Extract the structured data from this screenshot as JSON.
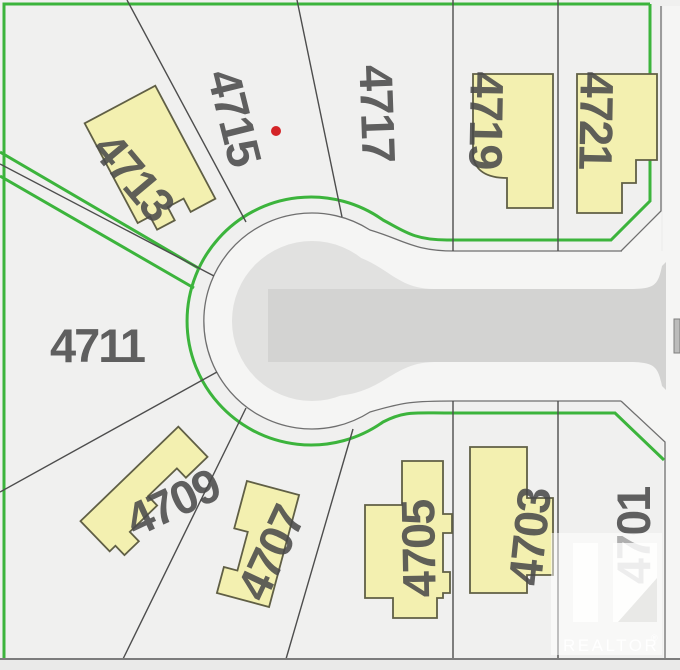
{
  "map": {
    "colors": {
      "background": "#f0f0ef",
      "right_of_way": "#f5f5f4",
      "bulb_pavement": "#e1e1e0",
      "road_strip": "#d3d3d2",
      "bottom_road": "#eaeae9",
      "green_line": "#3cb43c",
      "road_edge": "#6f6f6f",
      "lot_line": "#4d4d4d",
      "building_fill": "#f3f0b0",
      "building_stroke": "#605f45",
      "label": "#4a4a4a",
      "red_dot": "#d42427",
      "bottom_line": "#7c7c7c"
    },
    "red_dot": {
      "x": 276,
      "y": 131,
      "r": 5
    },
    "lots": [
      {
        "number": "4711",
        "x": 97,
        "y": 345,
        "rotate": 0
      },
      {
        "number": "4713",
        "x": 134,
        "y": 176,
        "rotate": 50
      },
      {
        "number": "4715",
        "x": 235,
        "y": 117,
        "rotate": 76
      },
      {
        "number": "4717",
        "x": 378,
        "y": 113,
        "rotate": 88
      },
      {
        "number": "4719",
        "x": 487,
        "y": 120,
        "rotate": 91
      },
      {
        "number": "4721",
        "x": 597,
        "y": 120,
        "rotate": 91
      },
      {
        "number": "4709",
        "x": 172,
        "y": 502,
        "rotate": -25
      },
      {
        "number": "4707",
        "x": 270,
        "y": 553,
        "rotate": -65
      },
      {
        "number": "4705",
        "x": 418,
        "y": 549,
        "rotate": -91
      },
      {
        "number": "4703",
        "x": 529,
        "y": 537,
        "rotate": -84
      },
      {
        "number": "4701",
        "x": 633,
        "y": 536,
        "rotate": -90
      }
    ],
    "layers": [
      {
        "tag": "rect",
        "name": "map-background",
        "attrs": {
          "x": 0,
          "y": 0,
          "width": 680,
          "height": 670,
          "fill": "#f0f0ef"
        }
      },
      {
        "tag": "rect",
        "name": "bottom-road-strip",
        "attrs": {
          "x": 0,
          "y": 660,
          "width": 680,
          "height": 10,
          "fill": "#eaeae9"
        }
      },
      {
        "tag": "path",
        "name": "right-of-way-margin",
        "attrs": {
          "d": "M663,6 H680 V659 H663 Z",
          "fill": "#f5f5f4"
        }
      },
      {
        "tag": "path",
        "name": "right-of-way-culdesac",
        "attrs": {
          "d": "M455,251 C413,251 404,240 370,230 A108 108 0 1 0 370,412 C404,402 413,401 455,401 H680 V251 Z",
          "fill": "#f5f5f4"
        }
      },
      {
        "tag": "path",
        "name": "right-of-way-flare-top",
        "attrs": {
          "d": "M621,251 L661,211 L661,251 Z",
          "fill": "#f5f5f4"
        }
      },
      {
        "tag": "path",
        "name": "right-of-way-flare-bottom",
        "attrs": {
          "d": "M621,401 L665,442 L665,401 Z",
          "fill": "#f5f5f4"
        }
      },
      {
        "tag": "path",
        "name": "culdesac-bulb-pavement",
        "attrs": {
          "d": "M232,321 a80,80 0 1 0 160,0 a80,80 0 1 0 -160,0 Z",
          "fill": "#e1e1e0"
        }
      },
      {
        "tag": "path",
        "name": "culdesac-funnel-pavement",
        "attrs": {
          "d": "M338,252 C386,259 392,289 434,289 L434,362 C392,363 386,391 338,396 Z",
          "fill": "#e1e1e0"
        }
      },
      {
        "tag": "path",
        "name": "road-strip-pavement",
        "attrs": {
          "d": "M268,289 H630 C655,289 658,285 662,266 L666,262 L666,390 L662,386 C658,367 655,362 630,362 H268 Z",
          "fill": "#d3d3d2"
        }
      },
      {
        "tag": "rect",
        "name": "road-edge-widget",
        "attrs": {
          "x": 674,
          "y": 319,
          "width": 6,
          "height": 34,
          "fill": "#bcbcbb",
          "stroke": "#7e7e7e",
          "stroke-width": 1
        }
      },
      {
        "tag": "path",
        "name": "road-edge-culdesac",
        "attrs": {
          "d": "M622,251 H455 C413,251 404,240 370,230 A108 108 0 1 0 370,412 C404,402 413,401 455,401 H621",
          "fill": "none",
          "stroke": "#6f6f6f",
          "stroke-width": 1.3
        }
      },
      {
        "tag": "path",
        "name": "road-edge-flare-top",
        "attrs": {
          "d": "M621,251 L661,211 V6",
          "fill": "none",
          "stroke": "#6f6f6f",
          "stroke-width": 1.3
        }
      },
      {
        "tag": "path",
        "name": "road-edge-flare-bottom",
        "attrs": {
          "d": "M621,401 L665,442 V659",
          "fill": "none",
          "stroke": "#6f6f6f",
          "stroke-width": 1.3
        }
      },
      {
        "tag": "path",
        "name": "green-border",
        "attrs": {
          "d": "M650,4 H4 V659",
          "fill": "none",
          "stroke": "#3cb43c",
          "stroke-width": 3
        }
      },
      {
        "tag": "path",
        "name": "green-frontage-line",
        "attrs": {
          "d": "M650,4 V201 L611,240 H447 C414,240 404,231 383,220 A124 124 0 1 0 383,422 C404,411 414,413 447,413 H615 L664,460",
          "fill": "none",
          "stroke": "#3cb43c",
          "stroke-width": 3
        }
      },
      {
        "tag": "path",
        "name": "green-lane-line-upper",
        "attrs": {
          "d": "M0,152 L200,269",
          "fill": "none",
          "stroke": "#3cb43c",
          "stroke-width": 3
        }
      },
      {
        "tag": "path",
        "name": "green-lane-line-lower",
        "attrs": {
          "d": "M0,176 L194,288",
          "fill": "none",
          "stroke": "#3cb43c",
          "stroke-width": 3
        }
      },
      {
        "tag": "path",
        "name": "lot-line-4713-4715",
        "attrs": {
          "d": "M127,0 L246,222",
          "fill": "none",
          "stroke": "#4d4d4d",
          "stroke-width": 1.4
        }
      },
      {
        "tag": "path",
        "name": "lot-line-4715-4717",
        "attrs": {
          "d": "M297,0 L342,217",
          "fill": "none",
          "stroke": "#4d4d4d",
          "stroke-width": 1.4
        }
      },
      {
        "tag": "path",
        "name": "lot-line-lane",
        "attrs": {
          "d": "M0,164 L214,276",
          "fill": "none",
          "stroke": "#4d4d4d",
          "stroke-width": 1.4
        }
      },
      {
        "tag": "path",
        "name": "lot-line-4711-4709",
        "attrs": {
          "d": "M0,492 L217,372",
          "fill": "none",
          "stroke": "#4d4d4d",
          "stroke-width": 1.4
        }
      },
      {
        "tag": "path",
        "name": "lot-line-4709-4707",
        "attrs": {
          "d": "M246,408 L123,659",
          "fill": "none",
          "stroke": "#4d4d4d",
          "stroke-width": 1.4
        }
      },
      {
        "tag": "path",
        "name": "lot-line-4707-4705",
        "attrs": {
          "d": "M353,429 L286,659",
          "fill": "none",
          "stroke": "#4d4d4d",
          "stroke-width": 1.4
        }
      },
      {
        "tag": "path",
        "name": "lot-line-4705-4703",
        "attrs": {
          "d": "M453,401 V659",
          "fill": "none",
          "stroke": "#4d4d4d",
          "stroke-width": 1.4
        }
      },
      {
        "tag": "path",
        "name": "lot-line-4703-4701",
        "attrs": {
          "d": "M558,401 V659",
          "fill": "none",
          "stroke": "#4d4d4d",
          "stroke-width": 1.4
        }
      },
      {
        "tag": "path",
        "name": "lot-line-4717-4719",
        "attrs": {
          "d": "M453,0 V251",
          "fill": "none",
          "stroke": "#4d4d4d",
          "stroke-width": 1.4
        }
      },
      {
        "tag": "path",
        "name": "lot-line-4719-4721",
        "attrs": {
          "d": "M558,0 V251",
          "fill": "none",
          "stroke": "#4d4d4d",
          "stroke-width": 1.4
        }
      },
      {
        "tag": "path",
        "name": "bottom-road-line",
        "attrs": {
          "d": "M0,659 H680",
          "fill": "none",
          "stroke": "#7c7c7c",
          "stroke-width": 2
        }
      },
      {
        "tag": "path",
        "name": "building-4713",
        "attrs": {
          "transform": "translate(150,161) rotate(-28)",
          "d": "M-40,-64 H40 V64 H12 V49 H-6 V64 H-26 V49 H-40 Z",
          "fill": "#f3f0b0",
          "stroke": "#605f45",
          "stroke-width": 1.8
        }
      },
      {
        "tag": "path",
        "name": "building-4719",
        "attrs": {
          "d": "M473,74 H553 V208 H507 V178 C486,178 475,170 473,156 Z",
          "fill": "#f3f0b0",
          "stroke": "#605f45",
          "stroke-width": 1.8
        }
      },
      {
        "tag": "path",
        "name": "building-4721",
        "attrs": {
          "d": "M577,74 H657 V160 H636 V183 H622 V213 H577 Z",
          "fill": "#f3f0b0",
          "stroke": "#605f45",
          "stroke-width": 1.8
        }
      },
      {
        "tag": "path",
        "name": "building-4709",
        "attrs": {
          "transform": "translate(144,489) rotate(-44)",
          "d": "M-68,-21 H68 V21 H38 V8 H-2 V21 H-40 V34 H-60 V21 H-68 Z",
          "fill": "#f3f0b0",
          "stroke": "#605f45",
          "stroke-width": 1.8
        }
      },
      {
        "tag": "path",
        "name": "building-4707",
        "attrs": {
          "transform": "translate(258,544) rotate(15)",
          "d": "M-27,-58 H27 V58 H-27 V31 H-13 V-9 H-27 Z",
          "fill": "#f3f0b0",
          "stroke": "#605f45",
          "stroke-width": 1.8
        }
      },
      {
        "tag": "path",
        "name": "building-4705",
        "attrs": {
          "d": "M402,461 H443 V514 H452 V533 H443 V572 H450 V593 H443 V598 H437 V618 H393 V598 H365 V505 H402 Z",
          "fill": "#f3f0b0",
          "stroke": "#605f45",
          "stroke-width": 1.8
        }
      },
      {
        "tag": "path",
        "name": "building-4703",
        "attrs": {
          "d": "M470,447 H527 V498 H553 V575 H527 V593 H470 Z",
          "fill": "#f3f0b0",
          "stroke": "#605f45",
          "stroke-width": 1.8
        }
      },
      {
        "tag": "circle",
        "name": "red-dot-marker",
        "attrs": {
          "cx": 276,
          "cy": 131,
          "r": 5,
          "fill": "#d42427"
        }
      }
    ],
    "overlay_layers": [
      {
        "tag": "rect",
        "name": "watermark-box",
        "attrs": {
          "x": 551,
          "y": 533,
          "width": 111,
          "height": 122,
          "fill": "rgba(255,255,255,0.5)"
        }
      },
      {
        "tag": "rect",
        "name": "realtor-logo-bar",
        "attrs": {
          "x": 573,
          "y": 543,
          "width": 25,
          "height": 79,
          "fill": "rgba(255,255,255,0.78)"
        }
      },
      {
        "tag": "rect",
        "name": "realtor-logo-square",
        "attrs": {
          "x": 613,
          "y": 543,
          "width": 44,
          "height": 79,
          "fill": "rgba(255,255,255,0.78)"
        }
      },
      {
        "tag": "path",
        "name": "realtor-logo-diagonal",
        "attrs": {
          "d": "M618,622 L657,622 L657,578 Z",
          "fill": "#e9e9e7"
        }
      },
      {
        "tag": "text",
        "name": "watermark-brand-text",
        "bind": "watermark.brand",
        "attrs": {
          "x": 563,
          "y": 651,
          "class": "wm-text"
        }
      },
      {
        "tag": "text",
        "name": "watermark-registered-mark",
        "bind": "watermark.registered",
        "attrs": {
          "x": 651,
          "y": 641,
          "class": "wm-reg"
        }
      }
    ]
  },
  "watermark": {
    "brand": "REALTOR",
    "registered": "®"
  }
}
